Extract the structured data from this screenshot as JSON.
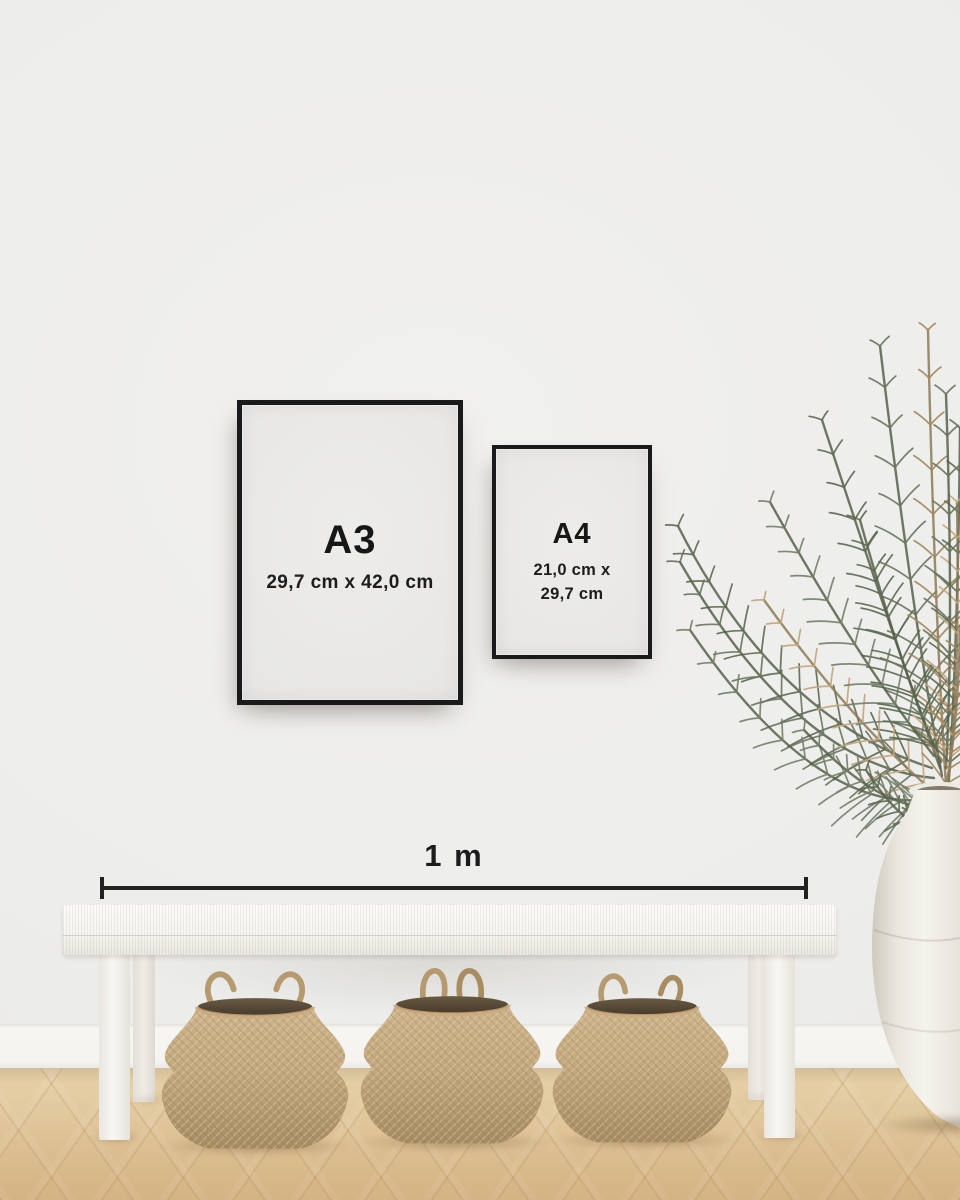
{
  "frames": [
    {
      "id": "a3",
      "label": "A3",
      "dimensions": "29,7 cm x 42,0 cm"
    },
    {
      "id": "a4",
      "label": "A4",
      "dimensions_line1": "21,0 cm x",
      "dimensions_line2": "29,7 cm"
    }
  ],
  "ruler": {
    "label": "1 m"
  },
  "colors": {
    "frame_black": "#1a1a1d",
    "paper_white": "#e9e8e6",
    "wall_gray": "#efeeec",
    "ruler_line": "#222222",
    "text": "#171717",
    "bench_white": "#f7f5f1",
    "floor_wood_light": "#e7d2ab",
    "floor_wood_dark": "#d4b384",
    "basket_tan": "#c3a87e",
    "basket_opening_brown": "#5c4e3a",
    "vase_white": "#f2f0ea",
    "plant_green": "#5e6a52",
    "plant_dried_tan": "#b3966c"
  }
}
